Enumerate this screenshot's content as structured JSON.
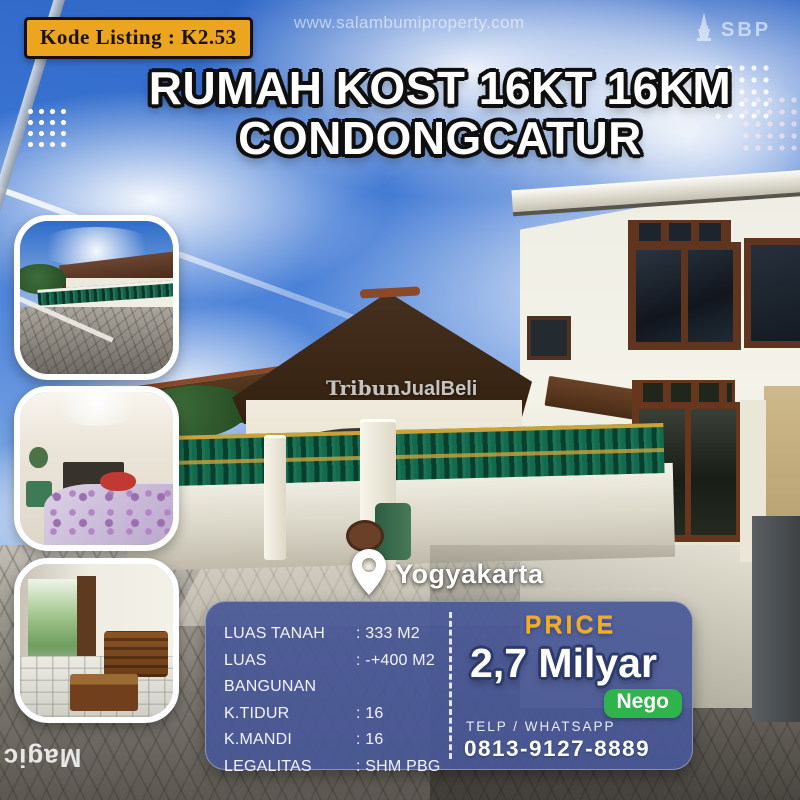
{
  "listing_badge": {
    "label": "Kode Listing : K2.53"
  },
  "site_watermark": "www.salambumiproperty.com",
  "brand_logo": {
    "text": "SBP",
    "icon": "tugu-monument-icon"
  },
  "title": {
    "line1": "RUMAH KOST 16KT 16KM",
    "line2": "CONDONGCATUR"
  },
  "location": {
    "name": "Yogyakarta",
    "icon": "map-pin-icon"
  },
  "specs": {
    "rows": [
      {
        "label": "LUAS TANAH",
        "value": ": 333 M2"
      },
      {
        "label": "LUAS BANGUNAN",
        "value": ": -+400 M2"
      },
      {
        "label": "K.TIDUR",
        "value": ": 16"
      },
      {
        "label": "K.MANDI",
        "value": ": 16"
      },
      {
        "label": "LEGALITAS",
        "value": ": SHM PBG"
      }
    ]
  },
  "price": {
    "heading": "PRICE",
    "amount": "2,7 Milyar",
    "negotiable_badge": "Nego",
    "contact_label": "TELP / WHATSAPP",
    "phone": "0813-9127-8889"
  },
  "watermarks": {
    "tribun_part1": "Tribun",
    "tribun_part2": "JualBeli",
    "side_text": "Magic"
  },
  "photos": [
    {
      "name": "street-front-view"
    },
    {
      "name": "bedroom"
    },
    {
      "name": "terrace-seating-area"
    }
  ],
  "colors": {
    "badge_bg": "#EBA51E",
    "panel_bg": "#495898",
    "price_heading": "#F6AC1D",
    "nego_bg": "#2FB44C",
    "sky_blue": "#2F6CC9"
  }
}
